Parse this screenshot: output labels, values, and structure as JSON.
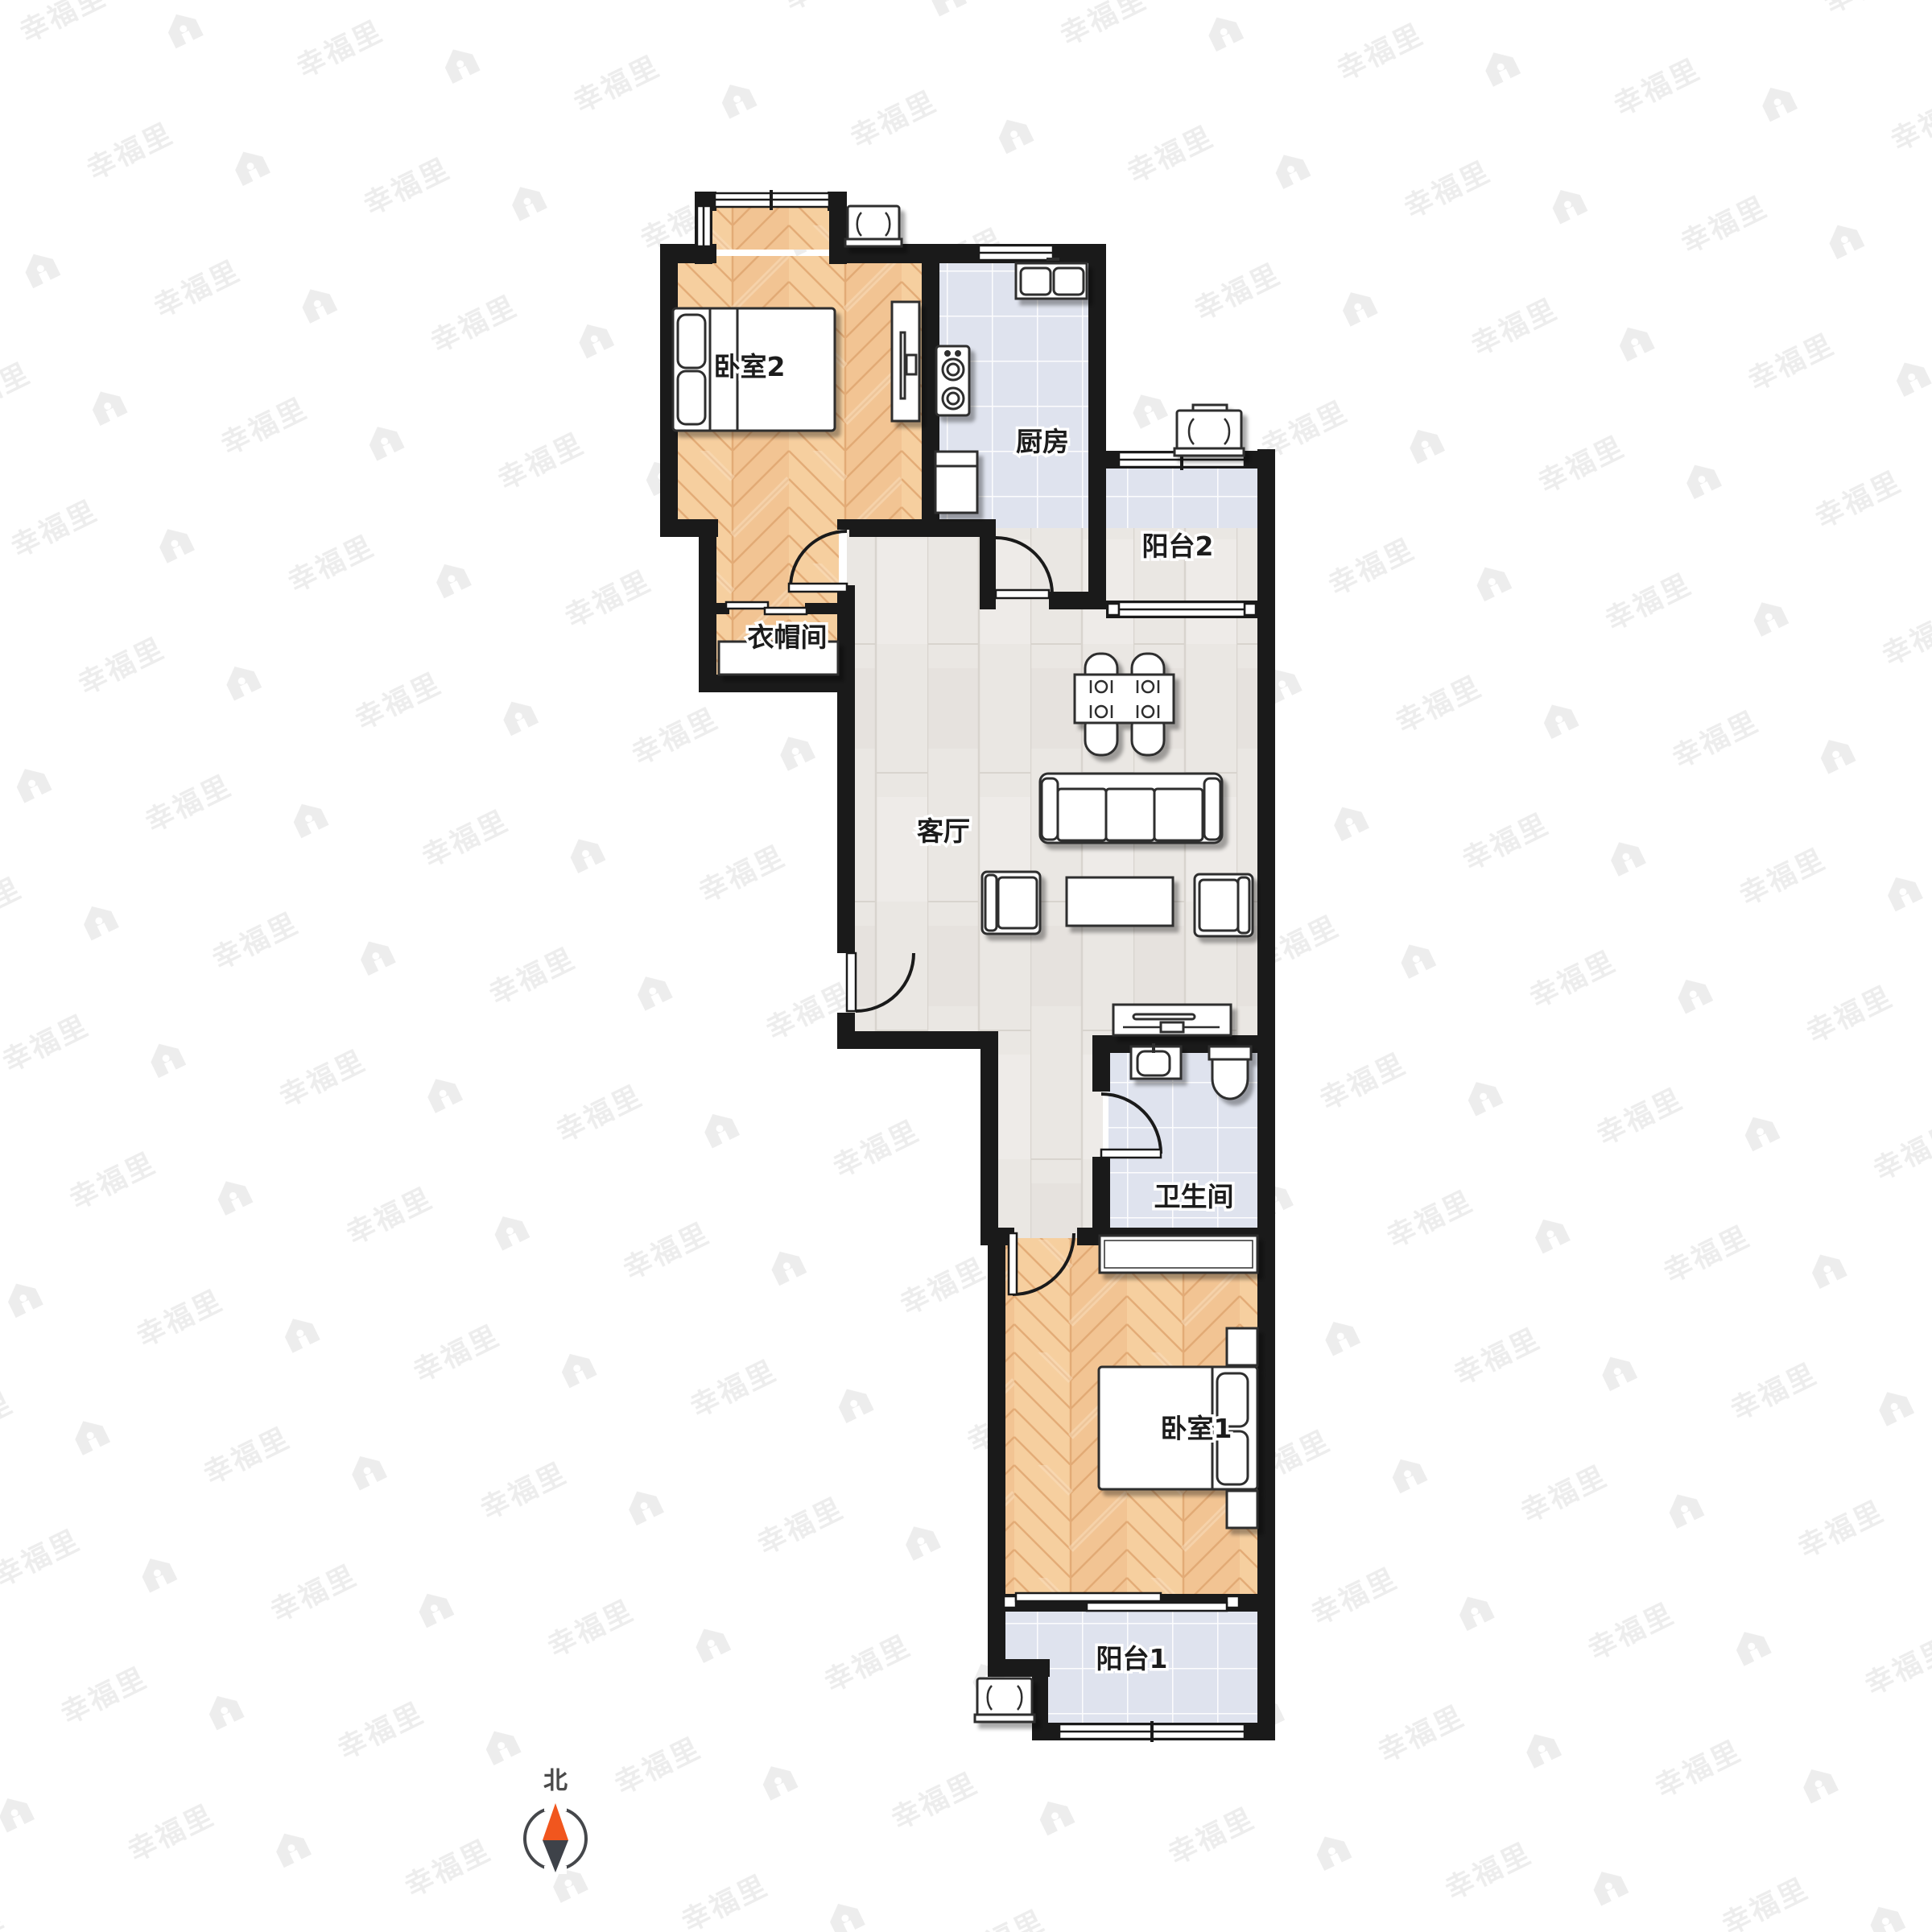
{
  "plan": {
    "type": "residential-floor-plan",
    "rooms": [
      {
        "id": "bedroom-2",
        "label": "卧室2"
      },
      {
        "id": "kitchen",
        "label": "厨房"
      },
      {
        "id": "balcony-2",
        "label": "阳台2"
      },
      {
        "id": "cloakroom",
        "label": "衣帽间"
      },
      {
        "id": "living-room",
        "label": "客厅"
      },
      {
        "id": "bathroom",
        "label": "卫生间"
      },
      {
        "id": "bedroom-1",
        "label": "卧室1"
      },
      {
        "id": "balcony-1",
        "label": "阳台1"
      }
    ],
    "compass": {
      "label": "北"
    },
    "watermark": {
      "text": "幸福里"
    },
    "palette": {
      "wall": "#1a1a1a",
      "bedroom_wood": "#f2c493",
      "bedroom_wood_light": "#fadfc0",
      "tile": "#dfe3ee",
      "tile_grout": "#ffffff",
      "living_plank": "#eae7e3",
      "furniture_fill": "#ffffff",
      "furniture_stroke": "#2f2f2f",
      "label_color": "#1c1c1c",
      "label_halo": "#ffffff",
      "compass_north": "#f1561e",
      "compass_south": "#3e4249",
      "watermark_color": "#ededed"
    }
  }
}
